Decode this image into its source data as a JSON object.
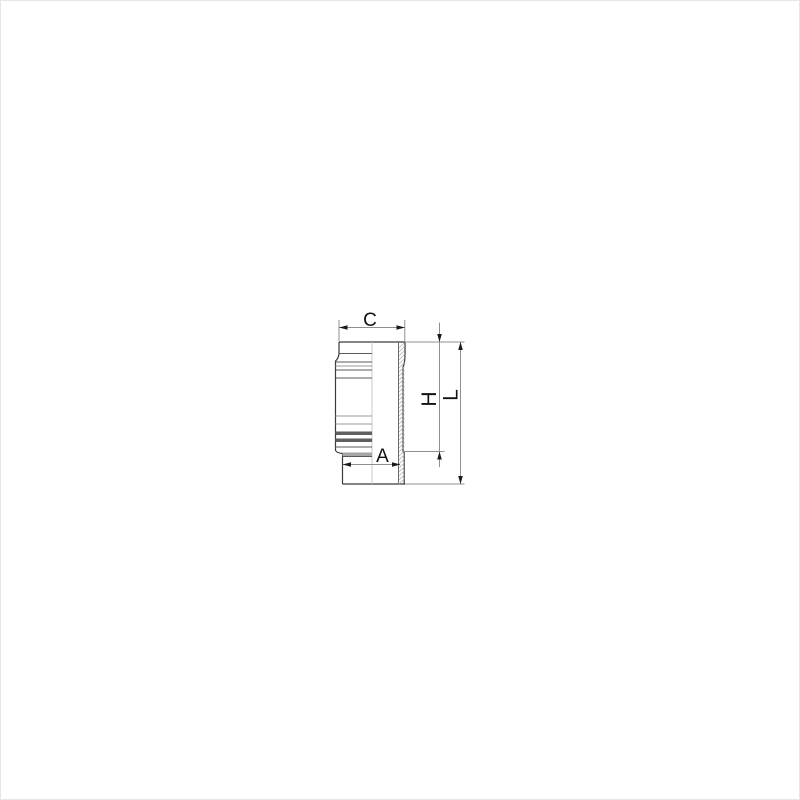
{
  "figure": {
    "type": "technical-drawing",
    "subject": "cylinder liner half-section side view",
    "dimensions": [
      {
        "id": "C",
        "label": "C",
        "orientation": "horizontal",
        "location": "top",
        "measures": "collar outer width"
      },
      {
        "id": "H",
        "label": "H",
        "orientation": "vertical-rotated",
        "location": "right-inner",
        "measures": "height from top face to lower step"
      },
      {
        "id": "L",
        "label": "L",
        "orientation": "vertical-rotated",
        "location": "right-outer",
        "measures": "total length"
      },
      {
        "id": "A",
        "label": "A",
        "orientation": "horizontal",
        "location": "bottom",
        "measures": "lower body width"
      }
    ],
    "colors": {
      "background": "#ffffff",
      "outline": "#3a3a3a",
      "dimension_line": "#8f8f8f",
      "arrowhead": "#1a1a1a",
      "label_text": "#111111",
      "hatch": "#b3b3b3",
      "centerline": "#c9c9c9"
    }
  }
}
